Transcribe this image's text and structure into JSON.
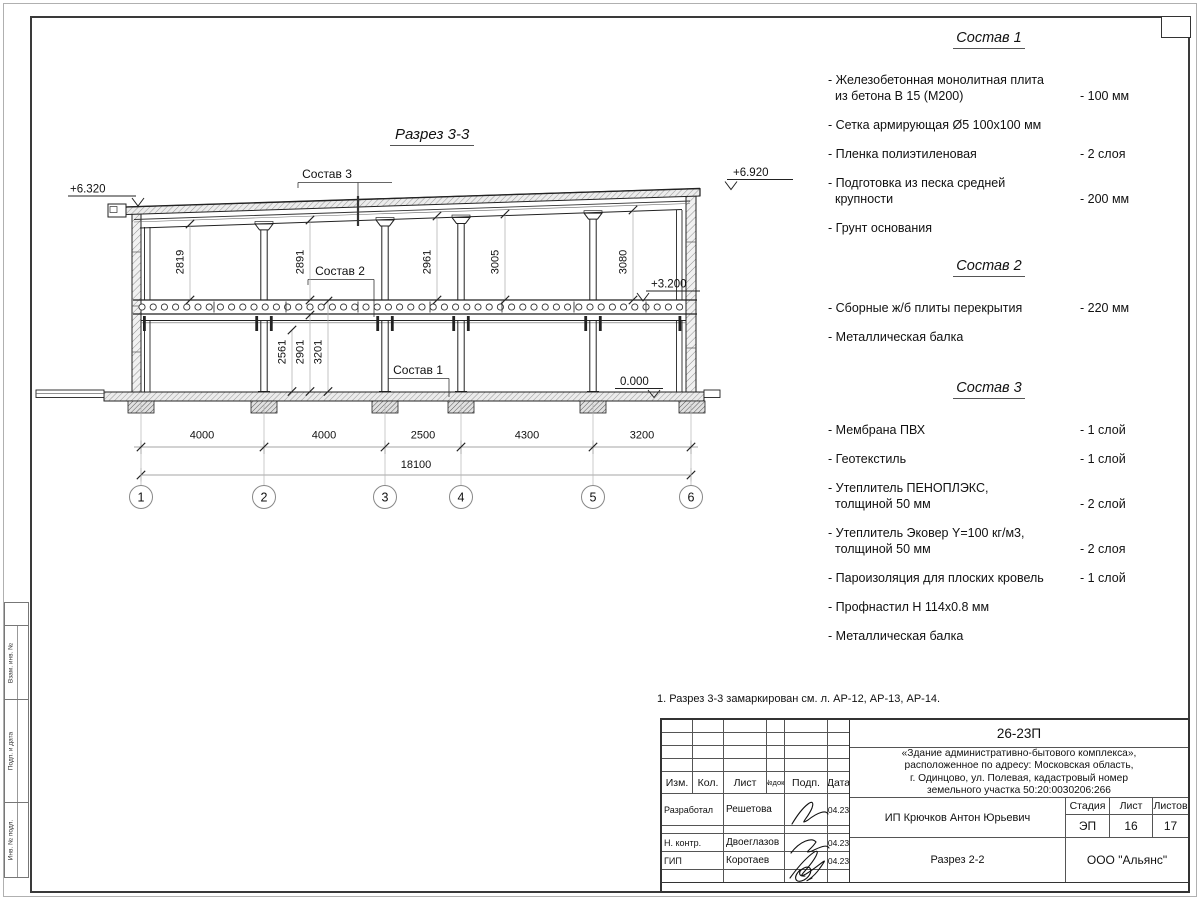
{
  "drawing": {
    "title": "Разрез 3-3",
    "elevations": {
      "eave_left": "+6.320",
      "eave_right": "+6.920",
      "floor": "+3.200",
      "ground": "0.000"
    },
    "upper_floor_heights": [
      "2819",
      "2891",
      "2961",
      "3005",
      "3080"
    ],
    "lower_floor_heights": [
      "2561",
      "2901",
      "3201"
    ],
    "bay_widths": [
      "4000",
      "4000",
      "2500",
      "4300",
      "3200"
    ],
    "total_width": "18100",
    "axis_labels": [
      "1",
      "2",
      "3",
      "4",
      "5",
      "6"
    ]
  },
  "compositions": [
    {
      "title": "Состав 1",
      "items": [
        {
          "text": "- Железобетонная  монолитная плита",
          "text2": "из бетона В 15 (М200)",
          "value": "- 100 мм"
        },
        {
          "text": "- Сетка армирующая Ø5 100х100 мм"
        },
        {
          "text": "- Пленка полиэтиленовая",
          "value": "-  2 слоя"
        },
        {
          "text": "- Подготовка из песка средней",
          "text2": "крупности",
          "value": "- 200 мм"
        },
        {
          "text": "- Грунт основания"
        }
      ]
    },
    {
      "title": "Состав 2",
      "items": [
        {
          "text": "- Сборные ж/б плиты перекрытия",
          "value": "- 220 мм"
        },
        {
          "text": "- Металлическая балка"
        }
      ]
    },
    {
      "title": "Состав 3",
      "items": [
        {
          "text": "- Мембрана ПВХ",
          "value": "- 1 слой"
        },
        {
          "text": "- Геотекстиль",
          "value": "- 1 слой"
        },
        {
          "text": "- Утеплитель ПЕНОПЛЭКС,",
          "text2": "толщиной 50 мм",
          "value": "- 2 слой"
        },
        {
          "text": "- Утеплитель Эковер Y=100 кг/м3,",
          "text2": "толщиной 50 мм",
          "value": "- 2 слоя"
        },
        {
          "text": "- Пароизоляция для плоских кровель",
          "value": "- 1 слой"
        },
        {
          "text": "- Профнастил Н 114х0.8 мм"
        },
        {
          "text": "- Металлическая балка"
        }
      ]
    }
  ],
  "note": "1. Разрез 3-3 замаркирован см. л. АР-12, АР-13, АР-14.",
  "title_block": {
    "doc_number": "26-23П",
    "project_lines": [
      "«Здание административно-бытового комплекса»,",
      "расположенное по адресу: Московская область,",
      "г. Одинцово, ул. Полевая, кадастровый номер",
      "земельного участка 50:20:0030206:266"
    ],
    "header_cols": [
      "Изм.",
      "Кол.",
      "Лист",
      "№док.",
      "Подп.",
      "Дата"
    ],
    "sign_rows": [
      {
        "role": "Разработал",
        "name": "Решетова",
        "date": "04.23"
      },
      {
        "role": "Н. контр.",
        "name": "Двоеглазов",
        "date": "04.23"
      },
      {
        "role": "ГИП",
        "name": "Коротаев",
        "date": "04.23"
      }
    ],
    "client": "ИП Крючков Антон Юрьевич",
    "stage_label": "Стадия",
    "sheet_label": "Лист",
    "sheets_label": "Листов",
    "stage": "ЭП",
    "sheet": "16",
    "sheets": "17",
    "drawing_name": "Разрез 2-2",
    "company": "ООО \"Альянс\""
  },
  "side_column_labels": [
    "Взам. инв. №",
    "Подп. и дата",
    "Инв. № подл."
  ]
}
